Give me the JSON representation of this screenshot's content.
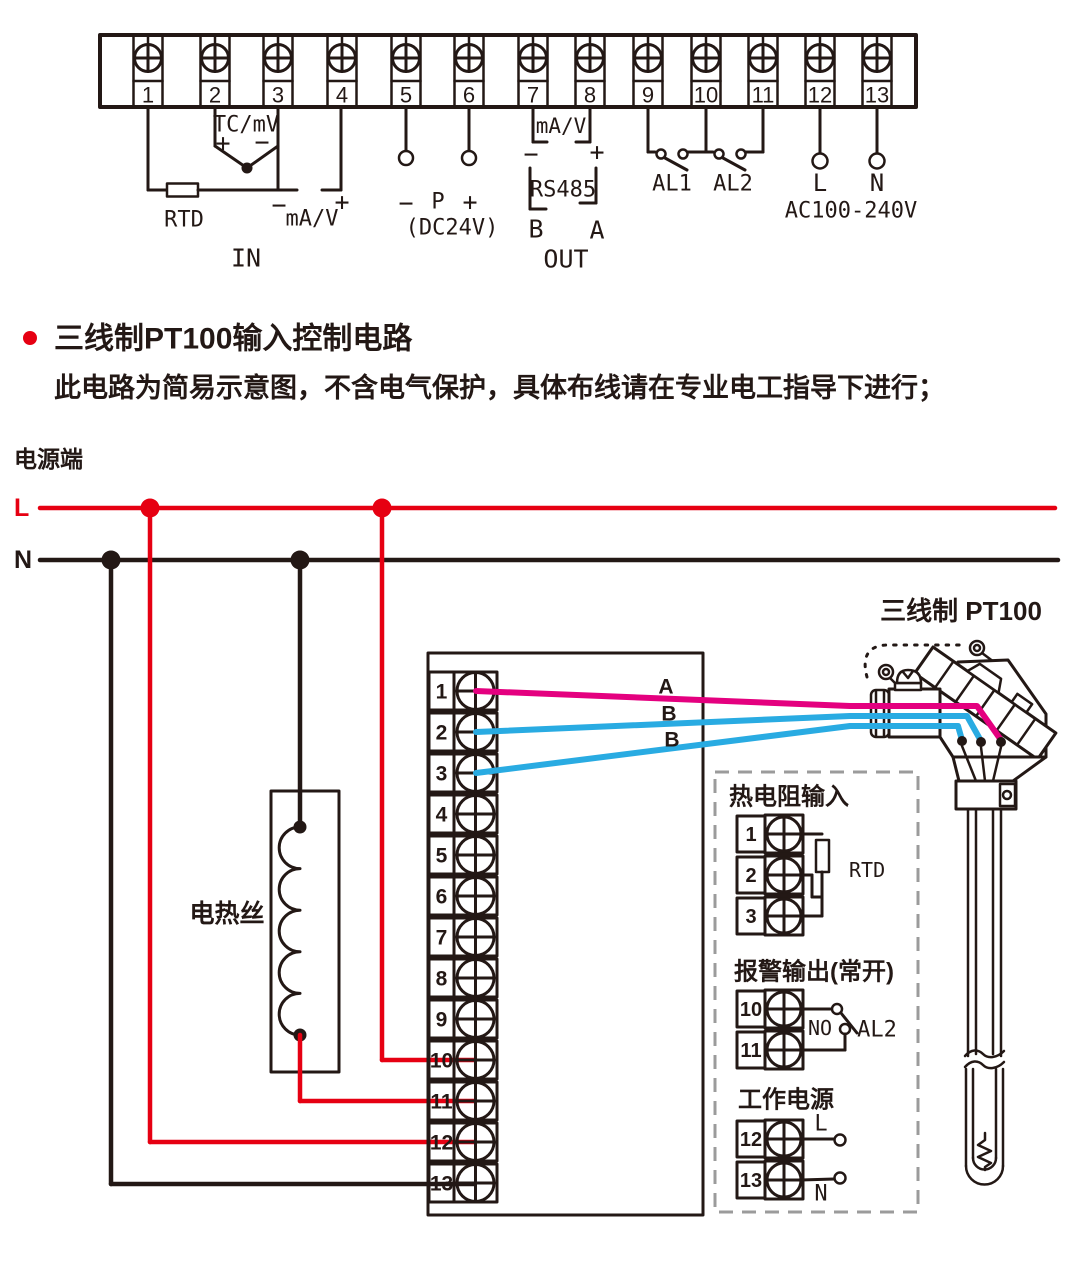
{
  "colors": {
    "ink": "#231815",
    "accent_red": "#e60012",
    "wire_magenta": "#e4007f",
    "wire_blue": "#29abe2",
    "dash_gray": "#9b9b9b"
  },
  "terminals": [
    "1",
    "2",
    "3",
    "4",
    "5",
    "6",
    "7",
    "8",
    "9",
    "10",
    "11",
    "12",
    "13"
  ],
  "top_diagram": {
    "tc_mv": "TC/mV",
    "plus": "+",
    "minus": "−",
    "rtd": "RTD",
    "ma_v": "mA/V",
    "in_label": "IN",
    "p": "P",
    "dc24v": "(DC24V)",
    "rs485": "RS485",
    "b": "B",
    "a": "A",
    "out_label": "OUT",
    "al1": "AL1",
    "al2": "AL2",
    "l": "L",
    "n": "N",
    "ac": "AC100-240V"
  },
  "section": {
    "title": "三线制PT100输入控制电路",
    "note": "此电路为简易示意图，不含电气保护，具体布线请在专业电工指导下进行；"
  },
  "circuit": {
    "power_terminal": "电源端",
    "l": "L",
    "n": "N",
    "heater": "电热丝",
    "sensor": "三线制 PT100",
    "wire_a": "A",
    "wire_b": "B",
    "inset": {
      "rtd_title": "热电阻输入",
      "rtd": "RTD",
      "alarm_title": "报警输出(常开)",
      "no": "NO",
      "al2": "AL2",
      "power_title": "工作电源",
      "l": "L",
      "n": "N"
    }
  }
}
